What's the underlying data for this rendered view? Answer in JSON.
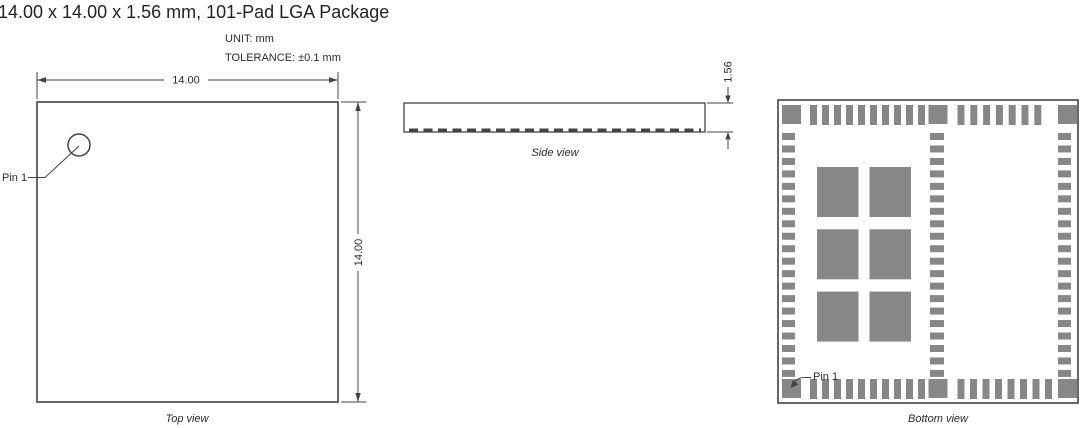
{
  "title": "14.00 x 14.00 x 1.56 mm, 101-Pad LGA Package",
  "notes": {
    "unit": "UNIT: mm",
    "tolerance": "TOLERANCE: ±0.1 mm"
  },
  "colors": {
    "line": "#434343",
    "pad": "#878787",
    "text": "#2b2b2b"
  },
  "top_view": {
    "caption": "Top view",
    "pin1_label": "Pin 1",
    "width_dim": "14.00",
    "height_dim": "14.00"
  },
  "side_view": {
    "caption": "Side view",
    "thickness_dim": "1.56"
  },
  "bottom_view": {
    "caption": "Bottom view",
    "pin1_label": "Pin 1",
    "pads": {
      "corner_count": 4,
      "mid_edge_count": 2,
      "top_row_left": 10,
      "top_row_right": 7,
      "bottom_row_left": 10,
      "bottom_row_right": 8,
      "left_column": 20,
      "middle_column": 20,
      "right_column": 20,
      "center_rows": 3,
      "center_cols": 2
    }
  }
}
